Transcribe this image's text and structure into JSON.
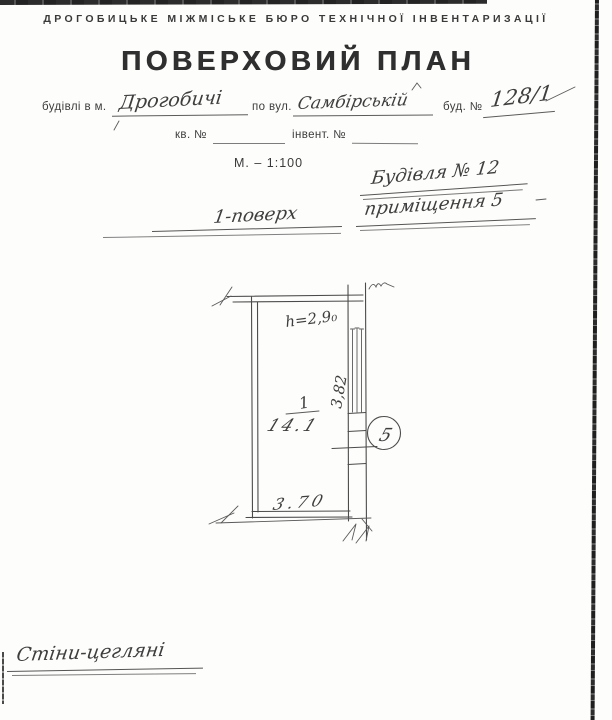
{
  "document": {
    "bureau_header": "ДРОГОБИЦЬКЕ МІЖМІСЬКЕ БЮРО ТЕХНІЧНОЇ ІНВЕНТАРИЗАЦІЇ",
    "title": "ПОВЕРХОВИЙ ПЛАН",
    "scale": "М. – 1:100"
  },
  "form": {
    "building_in_city_label": "будівлі в м.",
    "city_value": "Дрогобичі",
    "street_label": "по вул.",
    "street_value": "Самбірській",
    "house_label": "буд. №",
    "house_value": "128/1",
    "apartment_label": "кв. №",
    "inventory_label": "інвент. №"
  },
  "handwritten_notes": {
    "building_note": "Будівля № 12",
    "premises_note": "приміщення 5",
    "floor_note": "1-поверх",
    "walls_note": "Стіни-цегляні"
  },
  "plan": {
    "ceiling_height": "h=2,9₀",
    "room_number": "1",
    "room_area": "14.1",
    "width_dimension": "3.70",
    "side_dimension": "3,82",
    "premises_badge": "5"
  }
}
